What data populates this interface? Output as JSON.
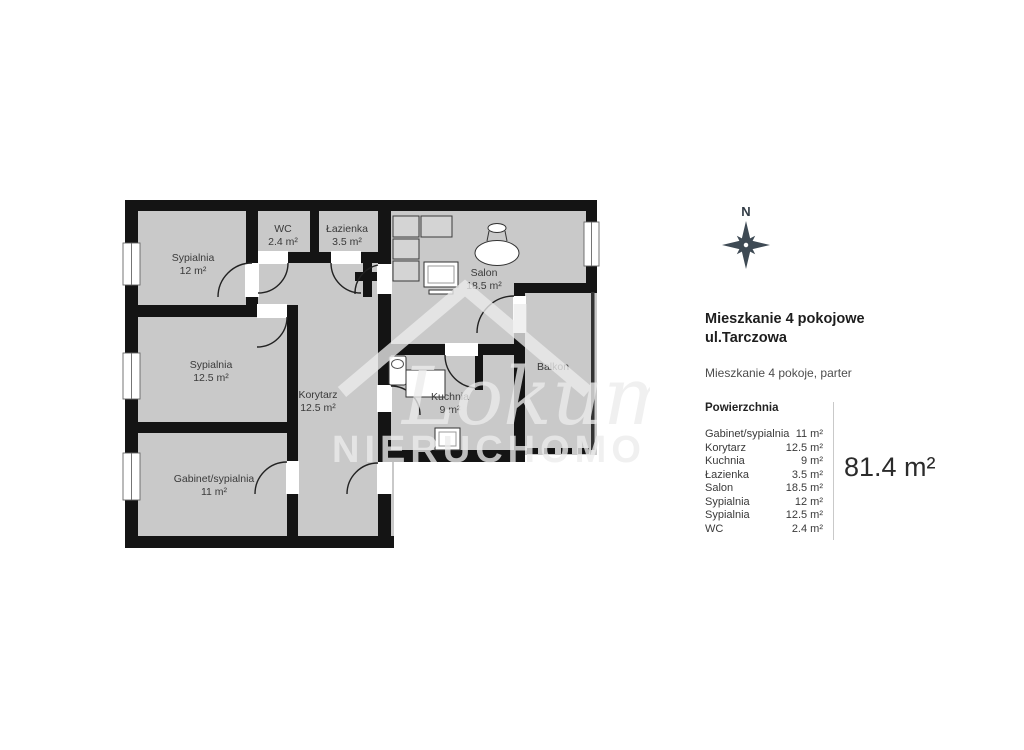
{
  "plan": {
    "compass_label": "N",
    "rooms": {
      "sypialnia1": {
        "name": "Sypialnia",
        "area": "12 m²"
      },
      "sypialnia2": {
        "name": "Sypialnia",
        "area": "12.5 m²"
      },
      "gabinet": {
        "name": "Gabinet/sypialnia",
        "area": "11 m²"
      },
      "korytarz": {
        "name": "Korytarz",
        "area": "12.5 m²"
      },
      "wc": {
        "name": "WC",
        "area": "2.4 m²"
      },
      "lazienka": {
        "name": "Łazienka",
        "area": "3.5 m²"
      },
      "salon": {
        "name": "Salon",
        "area": "18.5 m²"
      },
      "kuchnia": {
        "name": "Kuchnia",
        "area": "9 m²"
      },
      "balkon": {
        "name": "Balkon"
      }
    },
    "watermark": {
      "script": "Lokum",
      "caps": "NIERUCHOMO"
    }
  },
  "panel": {
    "title_line1": "Mieszkanie 4 pokojowe",
    "title_line2": "ul.Tarczowa",
    "subtitle": "Mieszkanie 4 pokoje, parter",
    "table_title": "Powierzchnia",
    "rows": [
      {
        "label": "Gabinet/sypialnia",
        "value": "11 m²"
      },
      {
        "label": "Korytarz",
        "value": "12.5 m²"
      },
      {
        "label": "Kuchnia",
        "value": "9 m²"
      },
      {
        "label": "Łazienka",
        "value": "3.5 m²"
      },
      {
        "label": "Salon",
        "value": "18.5 m²"
      },
      {
        "label": "Sypialnia",
        "value": "12 m²"
      },
      {
        "label": "Sypialnia",
        "value": "12.5 m²"
      },
      {
        "label": "WC",
        "value": "2.4 m²"
      }
    ],
    "total_area": "81.4 m²"
  },
  "colors": {
    "room_fill": "#c9c9c9",
    "wall": "#141414",
    "compass": "#3e4a54",
    "watermark": "#ececec"
  }
}
